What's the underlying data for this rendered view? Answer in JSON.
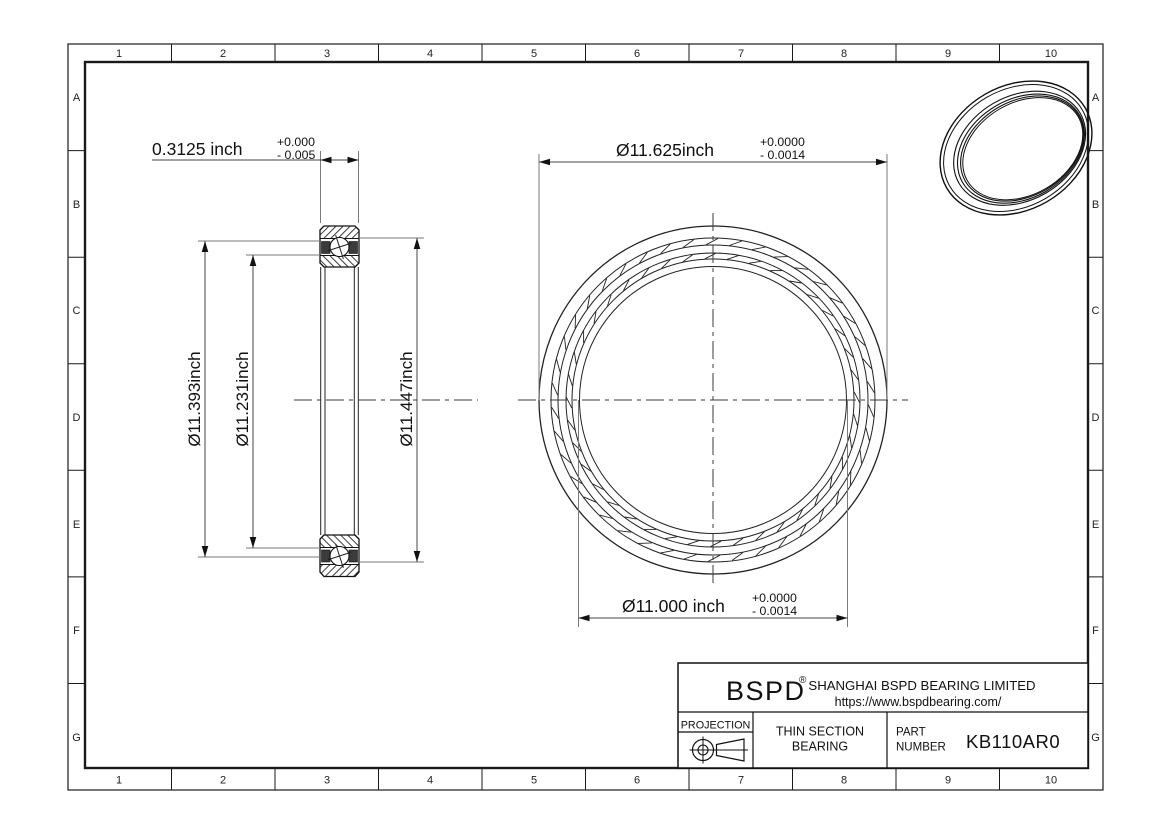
{
  "colors": {
    "line": "#1a1a1a",
    "background": "#ffffff"
  },
  "grid": {
    "columns": [
      "1",
      "2",
      "3",
      "4",
      "5",
      "6",
      "7",
      "8",
      "9",
      "10"
    ],
    "rows": [
      "A",
      "B",
      "C",
      "D",
      "E",
      "F",
      "G"
    ]
  },
  "section_view": {
    "width_dim": {
      "value": "0.3125 inch",
      "tol_top": "+0.000",
      "tol_bottom": "- 0.005"
    },
    "dia_left_outer": "Ø11.393inch",
    "dia_left_inner": "Ø11.231inch",
    "dia_right": "Ø11.447inch"
  },
  "front_view": {
    "od_dim": {
      "value": "Ø11.625inch",
      "tol_top": "+0.0000",
      "tol_bottom": "- 0.0014"
    },
    "bore_dim": {
      "value": "Ø11.000 inch",
      "tol_top": "+0.0000",
      "tol_bottom": "- 0.0014"
    }
  },
  "title_block": {
    "brand": "BSPD",
    "registered_mark": "®",
    "company": "SHANGHAI BSPD BEARING LIMITED",
    "website": "https://www.bspdbearing.com/",
    "projection_label": "PROJECTION",
    "projection_icon": "first-angle-projection",
    "product_type_line1": "THIN SECTION",
    "product_type_line2": "BEARING",
    "part_label_line1": "PART",
    "part_label_line2": "NUMBER",
    "part_number": "KB110AR0"
  }
}
